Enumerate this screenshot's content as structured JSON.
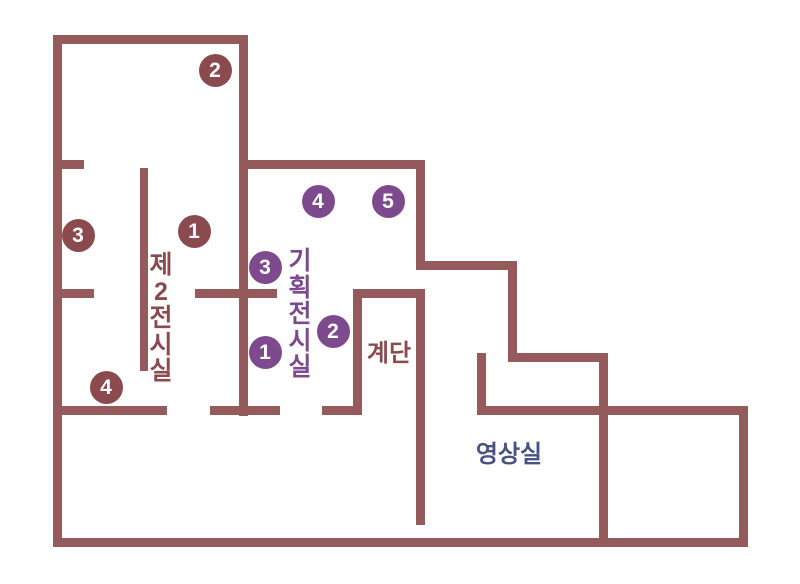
{
  "map": {
    "background_color": "#ffffff",
    "wall_color": "#955a5c",
    "accent_brown": "#8a4a4e",
    "accent_purple": "#7c4a8d",
    "accent_navy": "#475380",
    "rooms": [
      {
        "id": "exhibition-room-2",
        "label": "제2전시실",
        "orientation": "vertical",
        "color": "#8a4b4f",
        "x": 161,
        "y": 252
      },
      {
        "id": "special-exhibition-room",
        "label": "기획전시실",
        "orientation": "vertical",
        "color": "#7c4a8d",
        "x": 300,
        "y": 248
      },
      {
        "id": "stairs",
        "label": "계단",
        "orientation": "horizontal",
        "color": "#8a4b4f",
        "x": 389,
        "y": 340
      },
      {
        "id": "video-room",
        "label": "영상실",
        "orientation": "horizontal",
        "color": "#475380",
        "x": 509,
        "y": 441
      }
    ],
    "markers": [
      {
        "series": "exhibition",
        "number": "1",
        "color": "#8a4a4e",
        "cx": 194,
        "cy": 231
      },
      {
        "series": "exhibition",
        "number": "2",
        "color": "#8a4a4e",
        "cx": 215,
        "cy": 70
      },
      {
        "series": "exhibition",
        "number": "3",
        "color": "#8a4a4e",
        "cx": 78,
        "cy": 235
      },
      {
        "series": "exhibition",
        "number": "4",
        "color": "#8a4a4e",
        "cx": 106,
        "cy": 387
      },
      {
        "series": "special",
        "number": "1",
        "color": "#7c4a8d",
        "cx": 265,
        "cy": 352
      },
      {
        "series": "special",
        "number": "2",
        "color": "#7c4a8d",
        "cx": 333,
        "cy": 331
      },
      {
        "series": "special",
        "number": "3",
        "color": "#7c4a8d",
        "cx": 265,
        "cy": 267
      },
      {
        "series": "special",
        "number": "4",
        "color": "#7c4a8d",
        "cx": 318,
        "cy": 201
      },
      {
        "series": "special",
        "number": "5",
        "color": "#7c4a8d",
        "cx": 388,
        "cy": 201
      }
    ],
    "walls": [
      {
        "name": "outer-top",
        "x": 53,
        "y": 35,
        "w": 195,
        "h": 9
      },
      {
        "name": "outer-left",
        "x": 53,
        "y": 35,
        "w": 9,
        "h": 512
      },
      {
        "name": "outer-bottom",
        "x": 53,
        "y": 538,
        "w": 695,
        "h": 9
      },
      {
        "name": "center-divider",
        "x": 239,
        "y": 35,
        "w": 9,
        "h": 381
      },
      {
        "name": "special-room-top",
        "x": 239,
        "y": 160,
        "w": 186,
        "h": 9
      },
      {
        "name": "right-wall-upper",
        "x": 416,
        "y": 160,
        "w": 9,
        "h": 110
      },
      {
        "name": "step1-horizontal",
        "x": 416,
        "y": 261,
        "w": 101,
        "h": 9
      },
      {
        "name": "step1-vertical",
        "x": 508,
        "y": 261,
        "w": 9,
        "h": 101
      },
      {
        "name": "step2-horizontal",
        "x": 508,
        "y": 353,
        "w": 100,
        "h": 9
      },
      {
        "name": "mid-right-vertical",
        "x": 599,
        "y": 353,
        "w": 9,
        "h": 194
      },
      {
        "name": "lower-right-horizontal",
        "x": 477,
        "y": 406,
        "w": 271,
        "h": 9
      },
      {
        "name": "outer-right",
        "x": 739,
        "y": 406,
        "w": 9,
        "h": 141
      },
      {
        "name": "video-room-door-stub",
        "x": 477,
        "y": 353,
        "w": 9,
        "h": 62
      },
      {
        "name": "left-stub-upper",
        "x": 53,
        "y": 160,
        "w": 31,
        "h": 9
      },
      {
        "name": "left-stub-lower",
        "x": 53,
        "y": 289,
        "w": 41,
        "h": 9
      },
      {
        "name": "exhibit-partition",
        "x": 140,
        "y": 168,
        "w": 8,
        "h": 203
      },
      {
        "name": "middle-horizontal",
        "x": 195,
        "y": 289,
        "w": 82,
        "h": 9
      },
      {
        "name": "corridor-wall-1",
        "x": 57,
        "y": 406,
        "w": 110,
        "h": 9
      },
      {
        "name": "corridor-wall-2",
        "x": 210,
        "y": 406,
        "w": 70,
        "h": 9
      },
      {
        "name": "corridor-wall-3",
        "x": 322,
        "y": 406,
        "w": 40,
        "h": 9
      },
      {
        "name": "stairs-top",
        "x": 353,
        "y": 289,
        "w": 72,
        "h": 9
      },
      {
        "name": "stairs-left",
        "x": 353,
        "y": 289,
        "w": 9,
        "h": 126
      },
      {
        "name": "stairs-right",
        "x": 416,
        "y": 289,
        "w": 9,
        "h": 236
      }
    ]
  }
}
